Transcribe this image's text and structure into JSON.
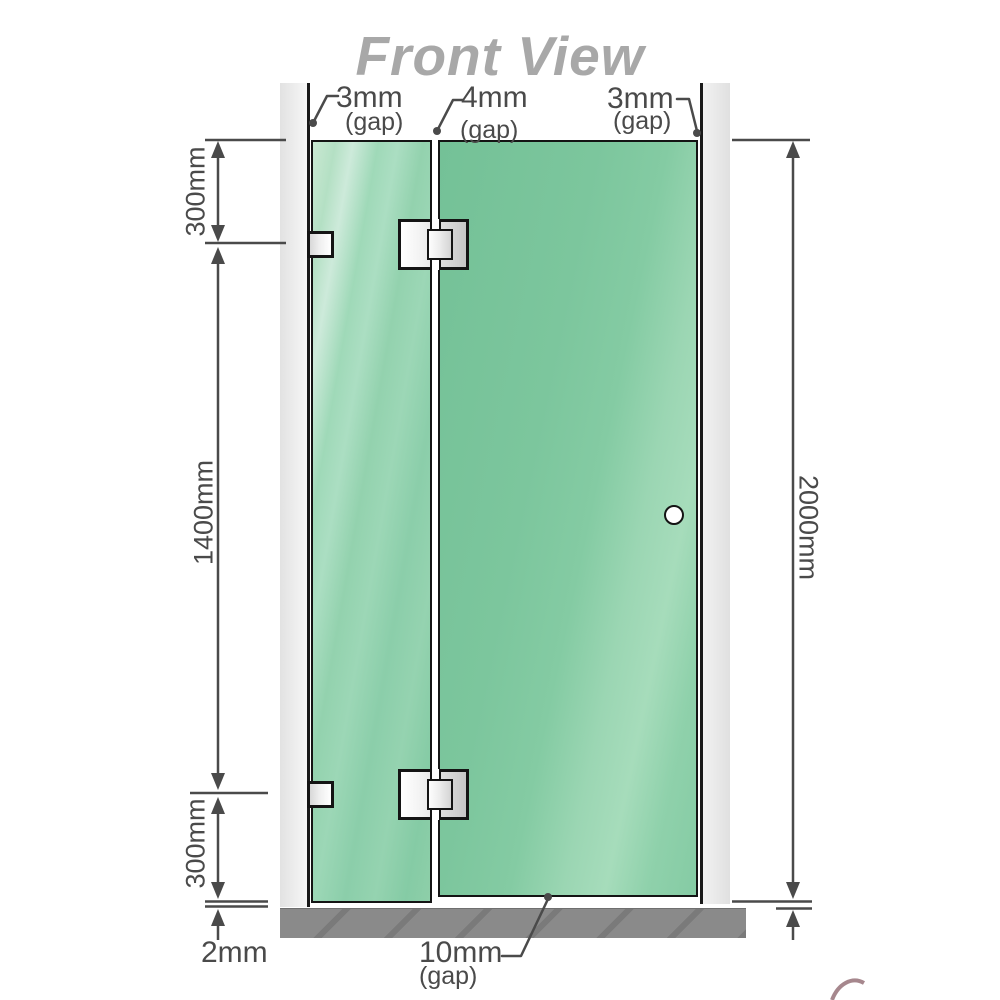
{
  "title": "Front View",
  "labels": {
    "gap_top_left": {
      "value": "3mm",
      "unit": "(gap)"
    },
    "gap_top_middle": {
      "value": "4mm",
      "unit": "(gap)"
    },
    "gap_top_right": {
      "value": "3mm",
      "unit": "(gap)"
    },
    "gap_bottom": {
      "value": "10mm",
      "unit": "(gap)"
    },
    "dim_left_top": "300mm",
    "dim_left_middle": "1400mm",
    "dim_left_bottom": "300mm",
    "dim_floor_gap": "2mm",
    "dim_right_total": "2000mm"
  },
  "colors": {
    "glass_fixed_panel": "#9cd7b6",
    "glass_door_panel": "#7cc69d",
    "wall_channel": "#e9e9e9",
    "floor": "#8a8a8a",
    "dimension_line": "#4a4a4a",
    "title_text": "#a8a8a8",
    "hardware": "#e8e8e8",
    "outline": "#141414"
  }
}
